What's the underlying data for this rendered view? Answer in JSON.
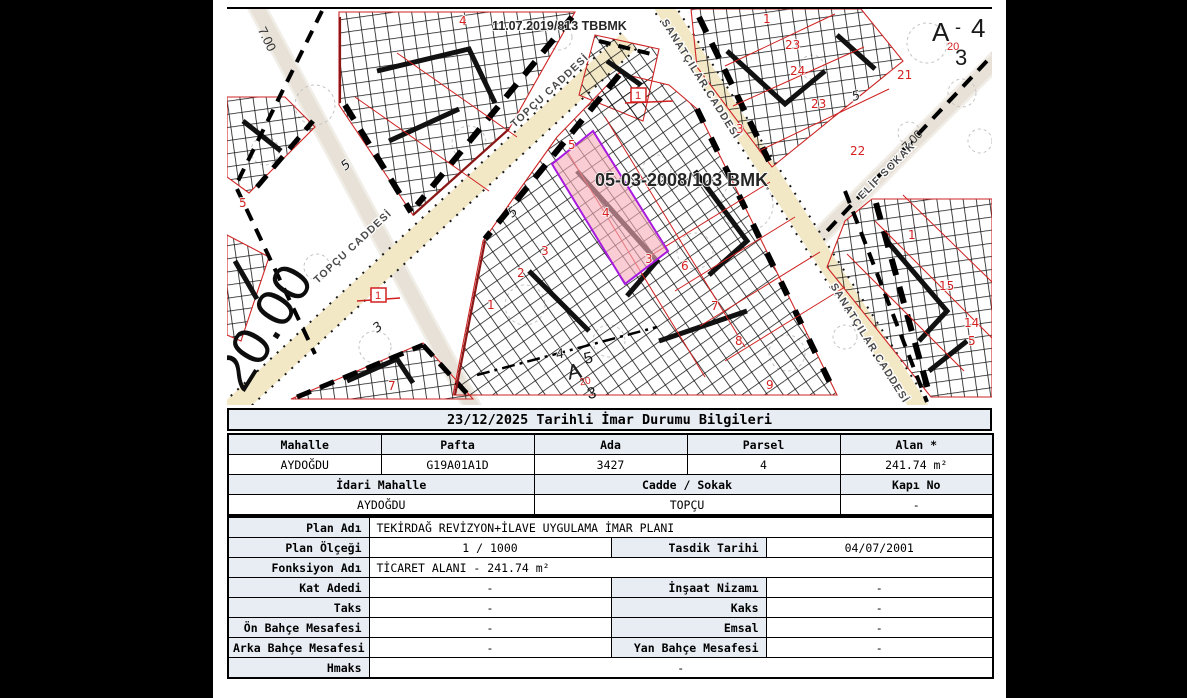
{
  "page": {
    "background": "#000000",
    "paper": "#ffffff",
    "table_header_bg": "#e8edf4",
    "accent_red": "#d42020",
    "parcel_fill": "#f5aeb8",
    "parcel_border": "#a81ae0",
    "road_beige": "#f3e8c6",
    "road_gray": "#e7e1d7"
  },
  "map": {
    "notes": [
      "11.07.2019/813 TBBMK",
      "05-03-2008/103 BMK"
    ],
    "road_labels": [
      "TOPÇU CADDESİ",
      "TOPÇU CADDESİ",
      "SANATÇILAR CADDESİ",
      "SANATÇILAR CADDESİ",
      "ELİF SOKAK"
    ],
    "width_labels": [
      "20.00",
      "7.00",
      "7.00"
    ],
    "block_labels": [
      "Kitle-4",
      "Kitle-4",
      "Kitle-4",
      "Kitle-4",
      "Kitle-4",
      "Kitle-",
      "-4"
    ],
    "area_labels": [
      "UA",
      "UA",
      "UA",
      "UA",
      "UA"
    ],
    "zoning_codes": [
      {
        "letter": "A",
        "dash": "-",
        "floors": "4",
        "code": "20",
        "density": "3"
      },
      {
        "letter": "A",
        "dash": "",
        "floors": "5",
        "code": "20",
        "density": "3"
      }
    ],
    "box_markers": [
      "1",
      "1"
    ],
    "subject_parcel_number": "4",
    "parcel_numbers": [
      {
        "t": "4",
        "x": 232,
        "y": 16
      },
      {
        "t": "1",
        "x": 536,
        "y": 14
      },
      {
        "t": "23",
        "x": 558,
        "y": 40
      },
      {
        "t": "24",
        "x": 563,
        "y": 66
      },
      {
        "t": "23",
        "x": 584,
        "y": 99
      },
      {
        "t": "21",
        "x": 670,
        "y": 70
      },
      {
        "t": "22",
        "x": 623,
        "y": 146
      },
      {
        "t": "5",
        "x": 341,
        "y": 140
      },
      {
        "t": "3",
        "x": 509,
        "y": 124
      },
      {
        "t": "4",
        "x": 375,
        "y": 208
      },
      {
        "t": "3",
        "x": 314,
        "y": 246
      },
      {
        "t": "3",
        "x": 418,
        "y": 254
      },
      {
        "t": "2",
        "x": 290,
        "y": 268
      },
      {
        "t": "1",
        "x": 260,
        "y": 300
      },
      {
        "t": "6",
        "x": 454,
        "y": 261
      },
      {
        "t": "7",
        "x": 484,
        "y": 301
      },
      {
        "t": "8",
        "x": 508,
        "y": 336
      },
      {
        "t": "9",
        "x": 539,
        "y": 380
      },
      {
        "t": "7",
        "x": 161,
        "y": 381
      },
      {
        "t": "15",
        "x": 712,
        "y": 281
      },
      {
        "t": "14",
        "x": 737,
        "y": 318
      },
      {
        "t": "1",
        "x": 681,
        "y": 230
      },
      {
        "t": "5",
        "x": 741,
        "y": 336
      },
      {
        "t": "5",
        "x": 12,
        "y": 198
      },
      {
        "t": "5",
        "x": 285,
        "y": 209,
        "r": -38,
        "cls": "bnum"
      },
      {
        "t": "5",
        "x": 118,
        "y": 162,
        "r": -38,
        "cls": "bnum"
      },
      {
        "t": "3",
        "x": 150,
        "y": 324,
        "r": -38,
        "cls": "bnum"
      },
      {
        "t": "5",
        "x": 626,
        "y": 92,
        "r": -15,
        "cls": "bnum"
      },
      {
        "t": "4",
        "x": 330,
        "y": 350,
        "r": -14,
        "cls": "bnum"
      }
    ]
  },
  "info": {
    "title": "23/12/2025 Tarihli İmar Durumu Bilgileri",
    "location_table": {
      "headers": [
        "Mahalle",
        "Pafta",
        "Ada",
        "Parsel",
        "Alan *"
      ],
      "values": [
        "AYDOĞDU",
        "G19A01A1D",
        "3427",
        "4",
        "241.74 m²"
      ],
      "headers2": [
        "İdari Mahalle",
        "Cadde / Sokak",
        "Kapı No"
      ],
      "values2": [
        "AYDOĞDU",
        "TOPÇU",
        "-"
      ]
    },
    "plan_table": {
      "rows": [
        {
          "label": "Plan Adı",
          "value": "TEKİRDAĞ REVİZYON+İLAVE UYGULAMA İMAR PLANI"
        },
        {
          "label": "Plan Ölçeği",
          "value": "1 / 1000",
          "label2": "Tasdik Tarihi",
          "value2": "04/07/2001"
        },
        {
          "label": "Fonksiyon Adı",
          "value": "TİCARET ALANI - 241.74 m²"
        },
        {
          "label": "Kat Adedi",
          "value": "-",
          "label2": "İnşaat Nizamı",
          "value2": "-"
        },
        {
          "label": "Taks",
          "value": "-",
          "label2": "Kaks",
          "value2": "-"
        },
        {
          "label": "Ön Bahçe Mesafesi",
          "value": "-",
          "label2": "Emsal",
          "value2": "-"
        },
        {
          "label": "Arka Bahçe Mesafesi",
          "value": "-",
          "label2": "Yan Bahçe Mesafesi",
          "value2": "-"
        },
        {
          "label": "Hmaks",
          "value": "-"
        }
      ]
    }
  }
}
